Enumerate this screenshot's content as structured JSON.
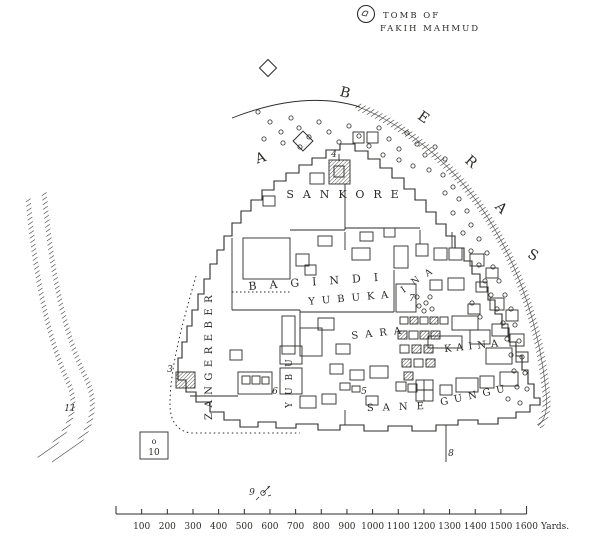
{
  "page": {
    "background": "#ffffff",
    "ink": "#2b2b28"
  },
  "tomb": {
    "line1": "TOMB OF",
    "line2": "FAKIH MAHMUD"
  },
  "edge_letters": [
    {
      "ch": "A",
      "x": 262,
      "y": 162,
      "rot": -18
    },
    {
      "ch": "B",
      "x": 344,
      "y": 97,
      "rot": 15
    },
    {
      "ch": "E",
      "x": 421,
      "y": 121,
      "rot": 35
    },
    {
      "ch": "R",
      "x": 468,
      "y": 165,
      "rot": 42
    },
    {
      "ch": "A",
      "x": 498,
      "y": 211,
      "rot": 45
    },
    {
      "ch": "S",
      "x": 531,
      "y": 259,
      "rot": 28
    }
  ],
  "quarter_labels": [
    {
      "text": "SANKORE",
      "x": 347,
      "y": 198,
      "spacing": 9,
      "size": 11,
      "rot": 0
    },
    {
      "text": "BAGINDI",
      "x": 320,
      "y": 285,
      "spacing": 13,
      "size": 11,
      "rot": -4
    },
    {
      "text": "YUBUKA",
      "x": 352,
      "y": 301,
      "spacing": 7,
      "size": 10,
      "rot": -5
    },
    {
      "text": "SARA",
      "x": 380,
      "y": 336,
      "spacing": 7,
      "size": 10,
      "rot": -6
    },
    {
      "text": "KAINA",
      "x": 474,
      "y": 349,
      "spacing": 5,
      "size": 10,
      "rot": -6
    },
    {
      "text": "SANE",
      "x": 400,
      "y": 410,
      "spacing": 9,
      "size": 10,
      "rot": -2
    },
    {
      "text": "GUNGU",
      "x": 476,
      "y": 398,
      "spacing": 6,
      "size": 10,
      "rot": -12
    }
  ],
  "diagonal_letters": [
    {
      "ch": "I",
      "x": 405,
      "y": 292,
      "rot": -35
    },
    {
      "ch": "N",
      "x": 417,
      "y": 283,
      "rot": -35
    },
    {
      "ch": "A",
      "x": 430,
      "y": 275,
      "rot": -35
    }
  ],
  "vertical_labels": [
    {
      "text": "ZANGEREBER",
      "x": 212,
      "y": 420,
      "spacing": 5.5,
      "size": 10
    },
    {
      "text": "YUBU",
      "x": 292,
      "y": 408,
      "spacing": 7,
      "size": 9
    }
  ],
  "markers": [
    {
      "n": "3",
      "x": 170,
      "y": 372
    },
    {
      "n": "4",
      "x": 334,
      "y": 157
    },
    {
      "n": "5",
      "x": 364,
      "y": 394
    },
    {
      "n": "6",
      "x": 275,
      "y": 394
    },
    {
      "n": "7",
      "x": 412,
      "y": 301
    },
    {
      "n": "8",
      "x": 451,
      "y": 456
    },
    {
      "n": "9",
      "x": 252,
      "y": 495
    },
    {
      "n": "11",
      "x": 70,
      "y": 411
    }
  ],
  "ref_box": {
    "top": "o",
    "bottom": "10"
  },
  "scale_bar": {
    "ticks": [
      "100",
      "200",
      "300",
      "400",
      "500",
      "600",
      "700",
      "800",
      "900",
      "1000",
      "1100",
      "1200",
      "1300",
      "1400",
      "1500",
      "1600"
    ],
    "unit": "Yards.",
    "x0": 116,
    "step": 25.66,
    "y": 514
  }
}
